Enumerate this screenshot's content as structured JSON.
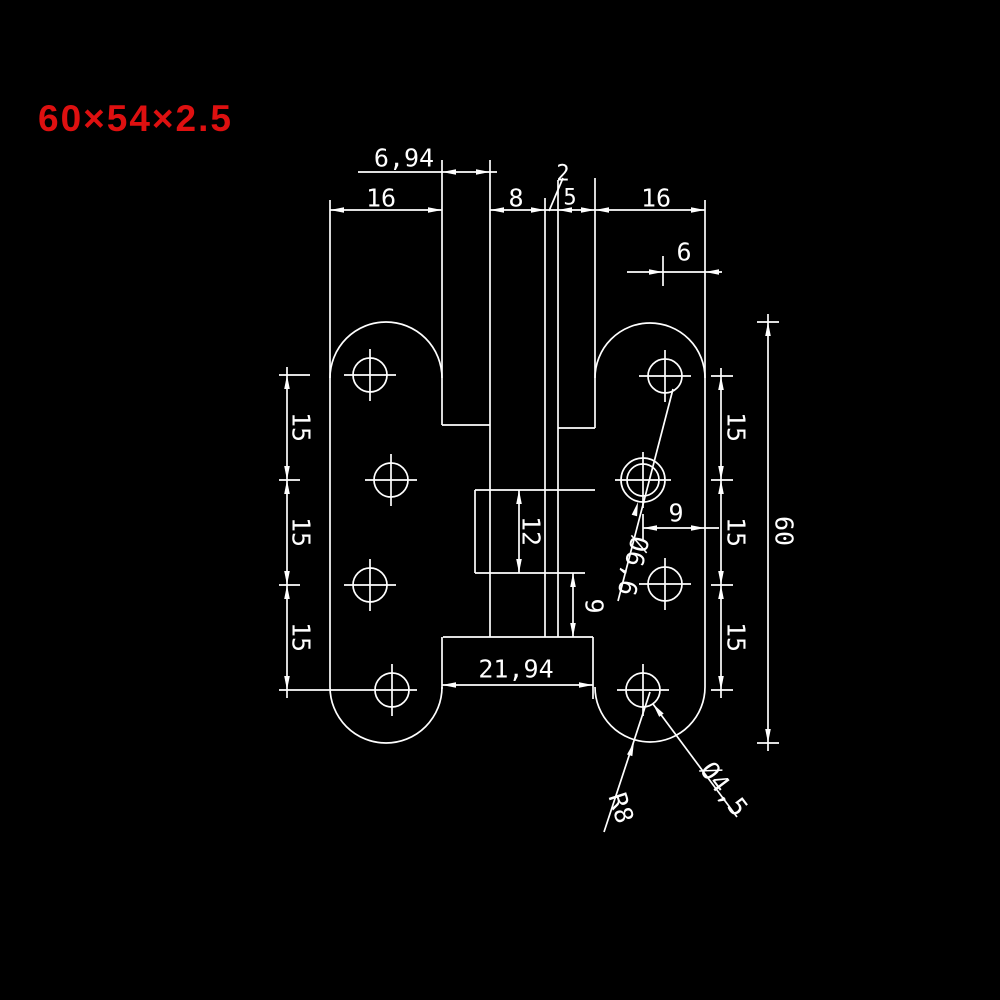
{
  "title": {
    "text": "60×54×2.5",
    "color": "#de1010"
  },
  "canvas": {
    "width": 1000,
    "height": 1000,
    "background": "#000000"
  },
  "drawing": {
    "stroke": "#ffffff",
    "stroke_width": 1.7,
    "font_size": 25,
    "part_name": "h-shaped-hinge-front-view",
    "lines": [
      [
        330,
        200,
        330,
        687
      ],
      [
        442,
        160,
        442,
        425
      ],
      [
        442,
        637,
        442,
        689
      ],
      [
        490,
        160,
        490,
        637
      ],
      [
        545,
        198,
        545,
        637
      ],
      [
        558,
        180,
        558,
        637
      ],
      [
        595,
        178,
        595,
        428
      ],
      [
        593,
        637,
        593,
        699
      ],
      [
        705,
        200,
        705,
        687
      ],
      [
        442,
        425,
        490,
        425
      ],
      [
        558,
        428,
        595,
        428
      ],
      [
        443,
        637,
        593,
        637
      ],
      [
        475,
        490,
        595,
        490
      ],
      [
        475,
        490,
        475,
        573
      ],
      [
        475,
        573,
        585,
        573
      ],
      [
        330,
        210,
        442,
        210
      ],
      [
        490,
        210,
        705,
        210
      ],
      [
        358,
        172,
        497,
        172
      ],
      [
        627,
        272,
        722,
        272
      ],
      [
        287,
        367,
        287,
        698
      ],
      [
        721,
        368,
        721,
        698
      ],
      [
        768,
        314,
        768,
        751
      ],
      [
        643,
        528,
        719,
        528
      ],
      [
        519,
        490,
        519,
        573
      ],
      [
        573,
        573,
        573,
        637
      ],
      [
        442,
        685,
        593,
        685
      ],
      [
        279,
        375,
        310,
        375
      ],
      [
        279,
        480,
        300,
        480
      ],
      [
        279,
        585,
        300,
        585
      ],
      [
        279,
        690,
        417,
        690
      ],
      [
        711,
        376,
        733,
        376
      ],
      [
        711,
        480,
        733,
        480
      ],
      [
        711,
        585,
        733,
        585
      ],
      [
        711,
        690,
        733,
        690
      ],
      [
        757,
        322,
        779,
        322
      ],
      [
        757,
        743,
        779,
        743
      ],
      [
        663,
        256,
        663,
        286
      ],
      [
        643,
        514,
        643,
        540
      ],
      [
        549,
        211,
        563,
        178
      ],
      [
        673,
        389,
        618,
        601
      ],
      [
        653,
        704,
        737,
        817
      ],
      [
        604,
        832,
        650,
        692
      ],
      [
        344,
        375,
        396,
        375
      ],
      [
        370,
        349,
        370,
        401
      ],
      [
        365,
        480,
        417,
        480
      ],
      [
        391,
        454,
        391,
        506
      ],
      [
        344,
        585,
        396,
        585
      ],
      [
        370,
        559,
        370,
        611
      ],
      [
        392,
        664,
        392,
        716
      ],
      [
        639,
        376,
        691,
        376
      ],
      [
        665,
        350,
        665,
        402
      ],
      [
        615,
        480,
        671,
        480
      ],
      [
        643,
        452,
        643,
        508
      ],
      [
        639,
        584,
        691,
        584
      ],
      [
        665,
        558,
        665,
        610
      ],
      [
        617,
        690,
        669,
        690
      ],
      [
        643,
        664,
        643,
        716
      ]
    ],
    "arcs": [
      "M330,378 A56,56 0 0 1 442,378",
      "M330,687 A56,56 0 0 0 442,687",
      "M595,378 A55,55 0 0 1 705,378",
      "M595,687 A55,55 0 0 0 705,687"
    ],
    "circles": [
      [
        370,
        375,
        17
      ],
      [
        391,
        480,
        17
      ],
      [
        370,
        585,
        17
      ],
      [
        392,
        690,
        17
      ],
      [
        665,
        376,
        17
      ],
      [
        643,
        480,
        16
      ],
      [
        643,
        480,
        22
      ],
      [
        665,
        584,
        17
      ],
      [
        643,
        690,
        17
      ]
    ],
    "arrows": [
      [
        330,
        210,
        180
      ],
      [
        442,
        210,
        0
      ],
      [
        442,
        172,
        180
      ],
      [
        490,
        172,
        0
      ],
      [
        490,
        210,
        180
      ],
      [
        545,
        210,
        0
      ],
      [
        558,
        210,
        180
      ],
      [
        595,
        210,
        0
      ],
      [
        595,
        210,
        180
      ],
      [
        705,
        210,
        0
      ],
      [
        663,
        272,
        0
      ],
      [
        705,
        272,
        180
      ],
      [
        287,
        375,
        270
      ],
      [
        287,
        480,
        90
      ],
      [
        287,
        480,
        270
      ],
      [
        287,
        585,
        90
      ],
      [
        287,
        585,
        270
      ],
      [
        287,
        690,
        90
      ],
      [
        721,
        376,
        270
      ],
      [
        721,
        480,
        90
      ],
      [
        721,
        480,
        270
      ],
      [
        721,
        585,
        90
      ],
      [
        721,
        585,
        270
      ],
      [
        721,
        690,
        90
      ],
      [
        768,
        322,
        270
      ],
      [
        768,
        743,
        90
      ],
      [
        643,
        528,
        180
      ],
      [
        705,
        528,
        0
      ],
      [
        519,
        490,
        270
      ],
      [
        519,
        573,
        90
      ],
      [
        573,
        573,
        270
      ],
      [
        573,
        637,
        90
      ],
      [
        442,
        685,
        180
      ],
      [
        593,
        685,
        0
      ],
      [
        638,
        502,
        285
      ],
      [
        653,
        704,
        233
      ],
      [
        634,
        742,
        288
      ]
    ],
    "labels": [
      {
        "name": "dim-6-94",
        "text": "6,94",
        "x": 404,
        "y": 158,
        "rot": 0,
        "size": 25
      },
      {
        "name": "dim-16-left",
        "text": "16",
        "x": 381,
        "y": 198,
        "rot": 0,
        "size": 25
      },
      {
        "name": "dim-8",
        "text": "8",
        "x": 516,
        "y": 198,
        "rot": 0,
        "size": 25
      },
      {
        "name": "dim-2",
        "text": "2",
        "x": 563,
        "y": 174,
        "rot": 0,
        "size": 22
      },
      {
        "name": "dim-5",
        "text": "5",
        "x": 570,
        "y": 198,
        "rot": 0,
        "size": 22
      },
      {
        "name": "dim-16-right",
        "text": "16",
        "x": 656,
        "y": 198,
        "rot": 0,
        "size": 25
      },
      {
        "name": "dim-6",
        "text": "6",
        "x": 684,
        "y": 252,
        "rot": 0,
        "size": 25
      },
      {
        "name": "dim-15-left-1",
        "text": "15",
        "x": 301,
        "y": 427,
        "rot": 90,
        "size": 25
      },
      {
        "name": "dim-15-left-2",
        "text": "15",
        "x": 301,
        "y": 532,
        "rot": 90,
        "size": 25
      },
      {
        "name": "dim-15-left-3",
        "text": "15",
        "x": 301,
        "y": 637,
        "rot": 90,
        "size": 25
      },
      {
        "name": "dim-15-right-1",
        "text": "15",
        "x": 736,
        "y": 427,
        "rot": 90,
        "size": 25
      },
      {
        "name": "dim-15-right-2",
        "text": "15",
        "x": 736,
        "y": 532,
        "rot": 90,
        "size": 25
      },
      {
        "name": "dim-15-right-3",
        "text": "15",
        "x": 736,
        "y": 637,
        "rot": 90,
        "size": 25
      },
      {
        "name": "dim-60",
        "text": "60",
        "x": 784,
        "y": 531,
        "rot": 90,
        "size": 25
      },
      {
        "name": "dim-12",
        "text": "12",
        "x": 531,
        "y": 531,
        "rot": 90,
        "size": 25
      },
      {
        "name": "dim-9-center",
        "text": "9",
        "x": 594,
        "y": 606,
        "rot": 90,
        "size": 25
      },
      {
        "name": "dim-9-right",
        "text": "9",
        "x": 676,
        "y": 513,
        "rot": 0,
        "size": 25
      },
      {
        "name": "dim-21-94",
        "text": "21,94",
        "x": 516,
        "y": 669,
        "rot": 0,
        "size": 25
      },
      {
        "name": "dim-dia-6-6",
        "text": "Ø6,6",
        "x": 633,
        "y": 566,
        "rot": 104,
        "size": 25
      },
      {
        "name": "dim-dia-4-5",
        "text": "Ø4,5",
        "x": 724,
        "y": 789,
        "rot": 53,
        "size": 25
      },
      {
        "name": "dim-r8",
        "text": "R8",
        "x": 621,
        "y": 808,
        "rot": 72,
        "size": 25
      }
    ]
  }
}
